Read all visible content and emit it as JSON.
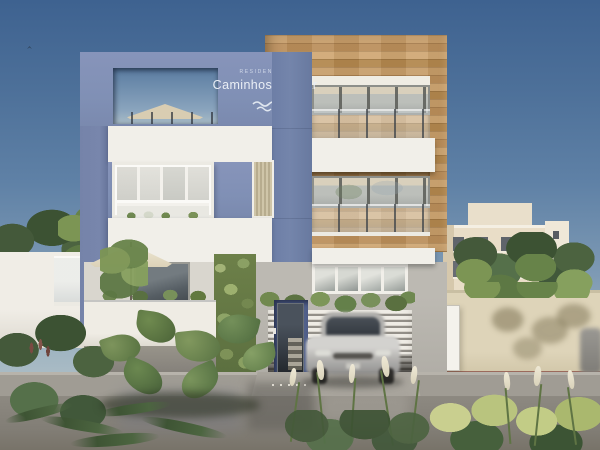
{
  "scene": {
    "type": "architectural-exterior-render",
    "sign": {
      "subtitle": "RESIDENCIAL",
      "title": "Caminhos do Mar",
      "logo": "wave-icon"
    },
    "palette": {
      "sky_top": "#3E6290",
      "sky_horizon": "#B6C4C9",
      "facade_blue": "#8090B5",
      "facade_blue_deep": "#66749A",
      "facade_white": "#F1EFE9",
      "wood_cladding": "#C49A66",
      "ground_floor_gray": "#B5B2AB",
      "garage_louver": "#EFECE5",
      "perimeter_wall_white": "#EDEAE2",
      "perimeter_wall_beige": "#DBD1B5",
      "curb_stripe_red": "#9B6A5C",
      "street": "#858179",
      "car_silver": "#B7B6B3",
      "umbrella_cream": "#E7DFCA",
      "foliage_dark": "#3F5233",
      "foliage_light": "#7C9554",
      "grass_plume": "#E8E2CF"
    },
    "objects": [
      "blue-and-white residential building",
      "wood-clad balcony tower",
      "rooftop terrace umbrella",
      "patio umbrella",
      "vertical garden green wall",
      "glass entrance with stairs",
      "silver car exiting louvered garage",
      "background apartment buildings",
      "perimeter walls",
      "wet street with ornamental grasses and ferns"
    ]
  }
}
